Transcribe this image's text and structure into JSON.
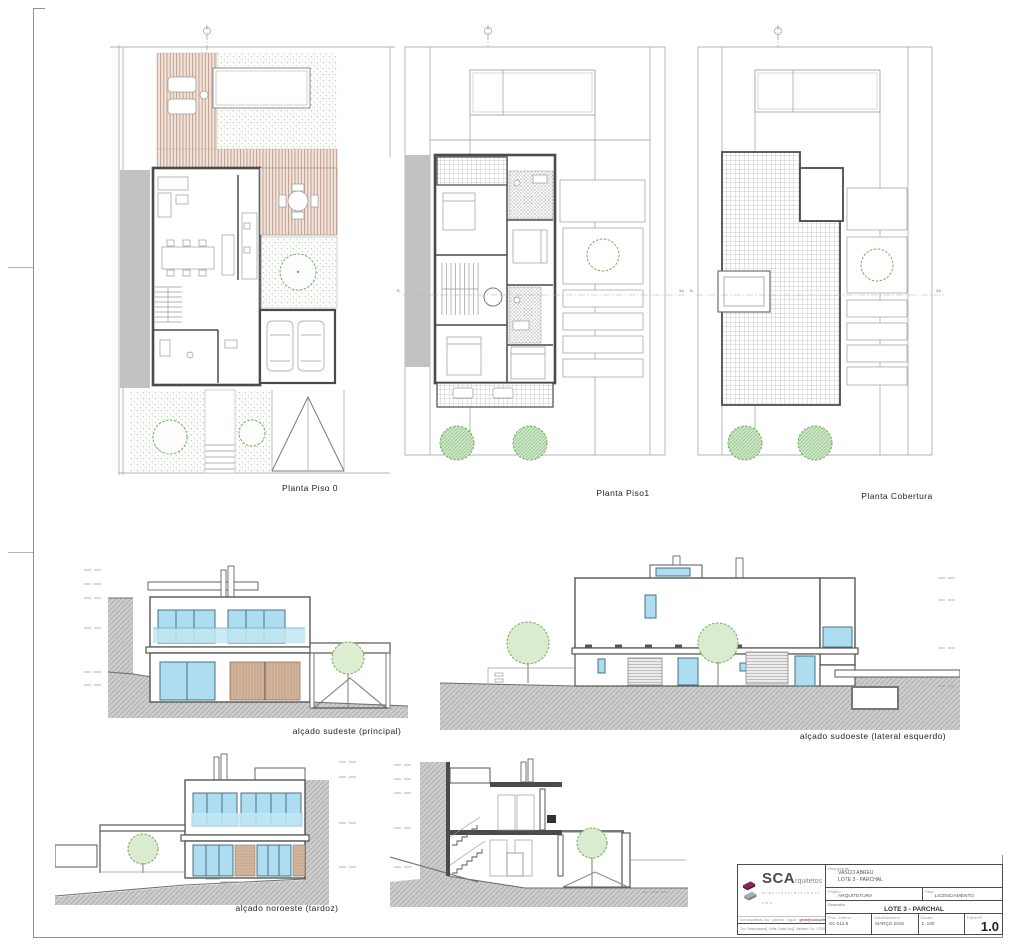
{
  "captions": {
    "plan0": "Planta Piso 0",
    "plan1": "Planta Piso1",
    "roof": "Planta Cobertura",
    "elev_se": "alçado sudeste (principal)",
    "elev_sw": "alçado sudoeste (lateral esquerdo)",
    "elev_nw": "alçado noroeste (tardoz)"
  },
  "annotations": {
    "section_left": "B.",
    "section_right": "3A"
  },
  "colors": {
    "brand_maroon": "#8c2150",
    "glass_blue": "#aedcf0",
    "garden_green": "#74b36e",
    "deck_tan": "#c59e8e",
    "ground_gray": "#cdcdcd"
  },
  "title_block": {
    "logo": {
      "acronym": "SCA",
      "name_rest": "rquitetos",
      "tagline": "a r q u i t e t u r a | u r b a n i s m o",
      "contact_left": "sca arquitetos, lda · parchal · lagoa ·",
      "contact_highlight": "geral@scarquitetos.com",
      "resp_label": "Téc. Responsável",
      "resp_name": "Sofia Costa, Arq.",
      "resp_number": "Membro OA · 17008"
    },
    "fields": {
      "requerente_label": "Requerente",
      "requerente_line1": "VASCO ABREU",
      "requerente_line2": "LOTE 3 - PARCHAL",
      "projeto_label": "Projeto",
      "projeto_value": "ARQUITETURA",
      "fase_label": "Fase",
      "fase_value": "LICENCIAMENTO",
      "desenho_label": "Desenho",
      "desenho_value": "LOTE 3 - PARCHAL",
      "proc_label": "Proc. Interno",
      "proc_value": "SC 012.6",
      "data_label": "Data/Desenho",
      "data_value": "MARÇO 2019",
      "escala_label": "Escala",
      "escala_value": "1: 100",
      "folha_label": "Folha Nº",
      "folha_value": "1.0"
    }
  }
}
